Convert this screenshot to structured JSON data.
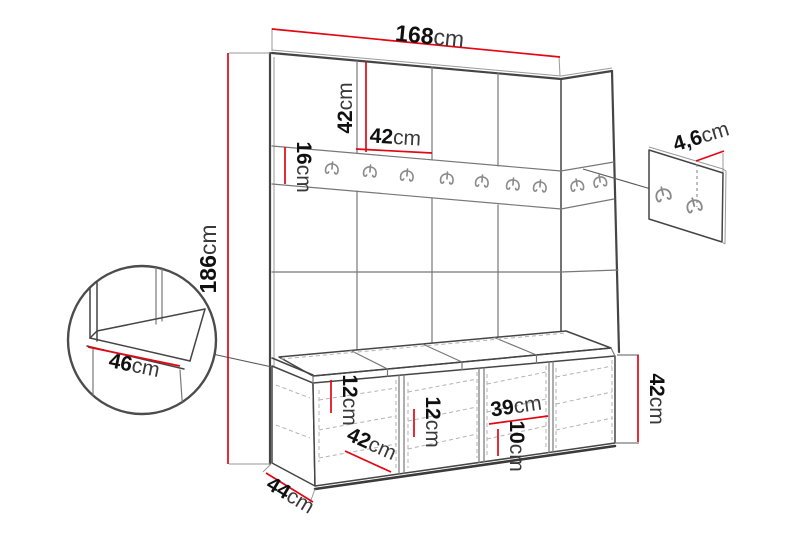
{
  "diagram": {
    "description": "Hallway wardrobe set dimension drawing: wall panel unit with coat hook rail, storage bench with cushions, seat corner detail and separate hook panel detail",
    "unit_symbol": "cm"
  },
  "dimensions": {
    "total_width": {
      "value": "168",
      "unit": "cm"
    },
    "panel_height": {
      "value": "42",
      "unit": "cm"
    },
    "panel_width": {
      "value": "42",
      "unit": "cm"
    },
    "rail_height": {
      "value": "16",
      "unit": "cm"
    },
    "total_height": {
      "value": "186",
      "unit": "cm"
    },
    "seat_depth_detail": {
      "value": "46",
      "unit": "cm"
    },
    "left_shelf_spacing": {
      "value": "12",
      "unit": "cm"
    },
    "door_width": {
      "value": "42",
      "unit": "cm"
    },
    "mid_shelf_spacing": {
      "value": "12",
      "unit": "cm"
    },
    "compartment_width": {
      "value": "39",
      "unit": "cm"
    },
    "right_shelf_spacing": {
      "value": "10",
      "unit": "cm"
    },
    "bench_depth": {
      "value": "44",
      "unit": "cm"
    },
    "bench_height": {
      "value": "42",
      "unit": "cm"
    },
    "hook_panel_offset": {
      "value": "4,6",
      "unit": "cm"
    }
  },
  "colors": {
    "dimension": "#e30613",
    "outline": "#454545",
    "grid": "#787878",
    "dashed": "#b3b3b3",
    "text": "#101010",
    "unit_text": "#3a3a3a"
  }
}
